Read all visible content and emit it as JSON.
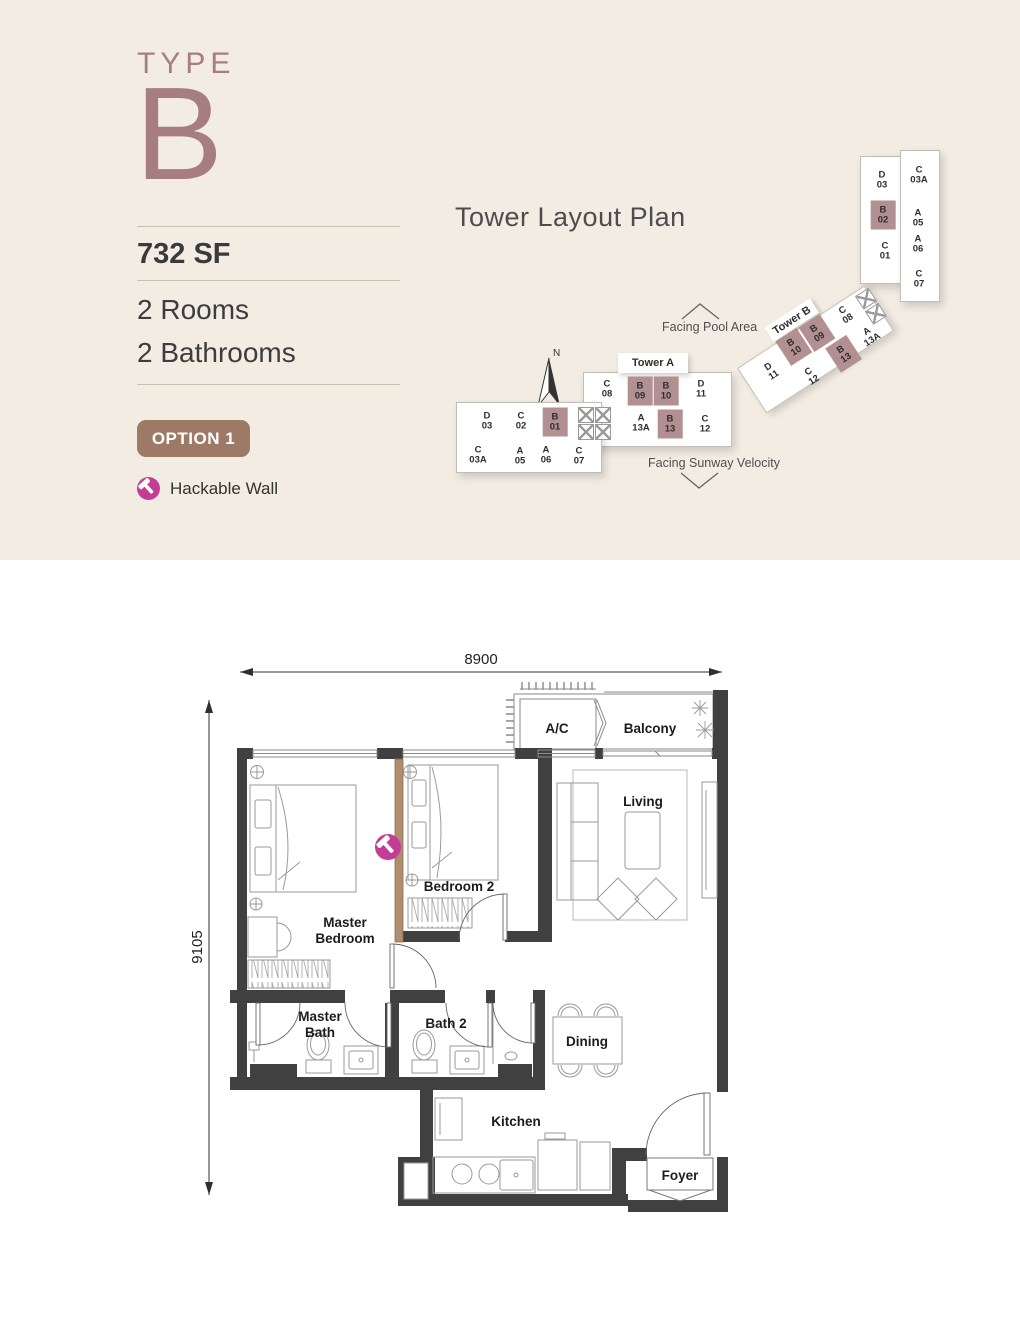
{
  "colors": {
    "background": "#f2ece3",
    "accent_mauve": "#a67e80",
    "unit_highlight": "#b29092",
    "option_brown": "#9c7a66",
    "hack_pink": "#c33d96",
    "wall_dark": "#404040",
    "hack_wall_tan": "#b18d6f"
  },
  "info": {
    "type_label": "TYPE",
    "type_value": "B",
    "area": "732 SF",
    "rooms": "2 Rooms",
    "bathrooms": "2 Bathrooms",
    "option": "OPTION 1",
    "legend_hackable": "Hackable Wall"
  },
  "tower_plan": {
    "title": "Tower Layout Plan",
    "facing_pool": "Facing Pool Area",
    "facing_velocity": "Facing Sunway Velocity",
    "north": "N",
    "tower_a": {
      "label": "Tower A",
      "main_top": [
        "C\n08",
        "B\n09",
        "B\n10",
        "D\n11"
      ],
      "main_bottom": [
        "A\n13A",
        "B\n13",
        "C\n12"
      ],
      "left_top": [
        "D\n03",
        "C\n02",
        "B\n01"
      ],
      "left_bottom": [
        "C\n03A",
        "A\n05",
        "A\n06",
        "C\n07"
      ]
    },
    "tower_b": {
      "label": "Tower B",
      "wing_top": [
        "D\n11",
        "B\n10",
        "B\n09",
        "C\n08"
      ],
      "wing_bottom": [
        "C\n12",
        "B\n13",
        "A\n13A"
      ],
      "vert_left": [
        "D\n03",
        "B\n02",
        "C\n01"
      ],
      "vert_right": [
        "C\n03A",
        "A\n05",
        "A\n06",
        "C\n07"
      ]
    }
  },
  "floor_plan": {
    "dim_width": "8900",
    "dim_height": "9105",
    "rooms": {
      "ac": "A/C",
      "balcony": "Balcony",
      "living": "Living",
      "bedroom2": "Bedroom 2",
      "master_line1": "Master",
      "master_line2": "Bedroom",
      "master_bath_line1": "Master",
      "master_bath_line2": "Bath",
      "bath2": "Bath 2",
      "dining": "Dining",
      "kitchen": "Kitchen",
      "foyer": "Foyer"
    }
  }
}
